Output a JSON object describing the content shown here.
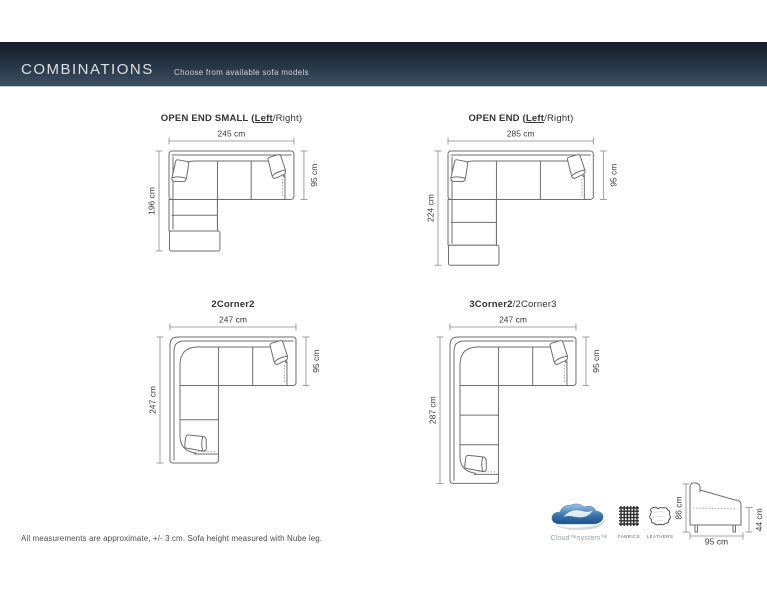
{
  "header": {
    "title": "COMBINATIONS",
    "subtitle": "Choose from available sofa models",
    "band_color_top": "#151e29",
    "band_color_bottom": "#3e4f61"
  },
  "diagrams": [
    {
      "id": "open-end-small",
      "title_prefix": "OPEN END SMALL (",
      "title_underlined": "Left",
      "title_suffix": "/Right)",
      "type": "open-end",
      "width_cm": 245,
      "height_cm": 196,
      "depth_cm": 95,
      "width_label": "245 cm",
      "height_label": "196 cm",
      "depth_label": "95 cm"
    },
    {
      "id": "open-end",
      "title_prefix": "OPEN END (",
      "title_underlined": "Left",
      "title_suffix": "/Right)",
      "type": "open-end",
      "width_cm": 285,
      "height_cm": 224,
      "depth_cm": 95,
      "width_label": "285 cm",
      "height_label": "224 cm",
      "depth_label": "95 cm"
    },
    {
      "id": "2corner2",
      "title_prefix": "2Corner2",
      "title_underlined": "",
      "title_suffix": "",
      "type": "corner",
      "width_cm": 247,
      "height_cm": 247,
      "depth_cm": 95,
      "width_label": "247 cm",
      "height_label": "247 cm",
      "depth_label": "95 cm"
    },
    {
      "id": "3corner2-2corner3",
      "title_prefix": "3Corner2",
      "title_underlined": "",
      "title_suffix": "/2Corner3",
      "type": "corner",
      "width_cm": 247,
      "height_cm": 287,
      "depth_cm": 95,
      "width_label": "247 cm",
      "height_label": "287 cm",
      "depth_label": "95 cm"
    }
  ],
  "footer": {
    "note": "All measurements are approximate, +/- 3 cm. Sofa height measured with Nube leg.",
    "cloud_logo_text": "Cloud™system™",
    "cloud_accent_color": "#2f6aa8",
    "fabrics_label": "FABRICS",
    "leathers_label": "LEATHERS",
    "side_view": {
      "height_label": "86 cm",
      "seat_height_label": "44 cm",
      "depth_label": "95 cm"
    }
  }
}
